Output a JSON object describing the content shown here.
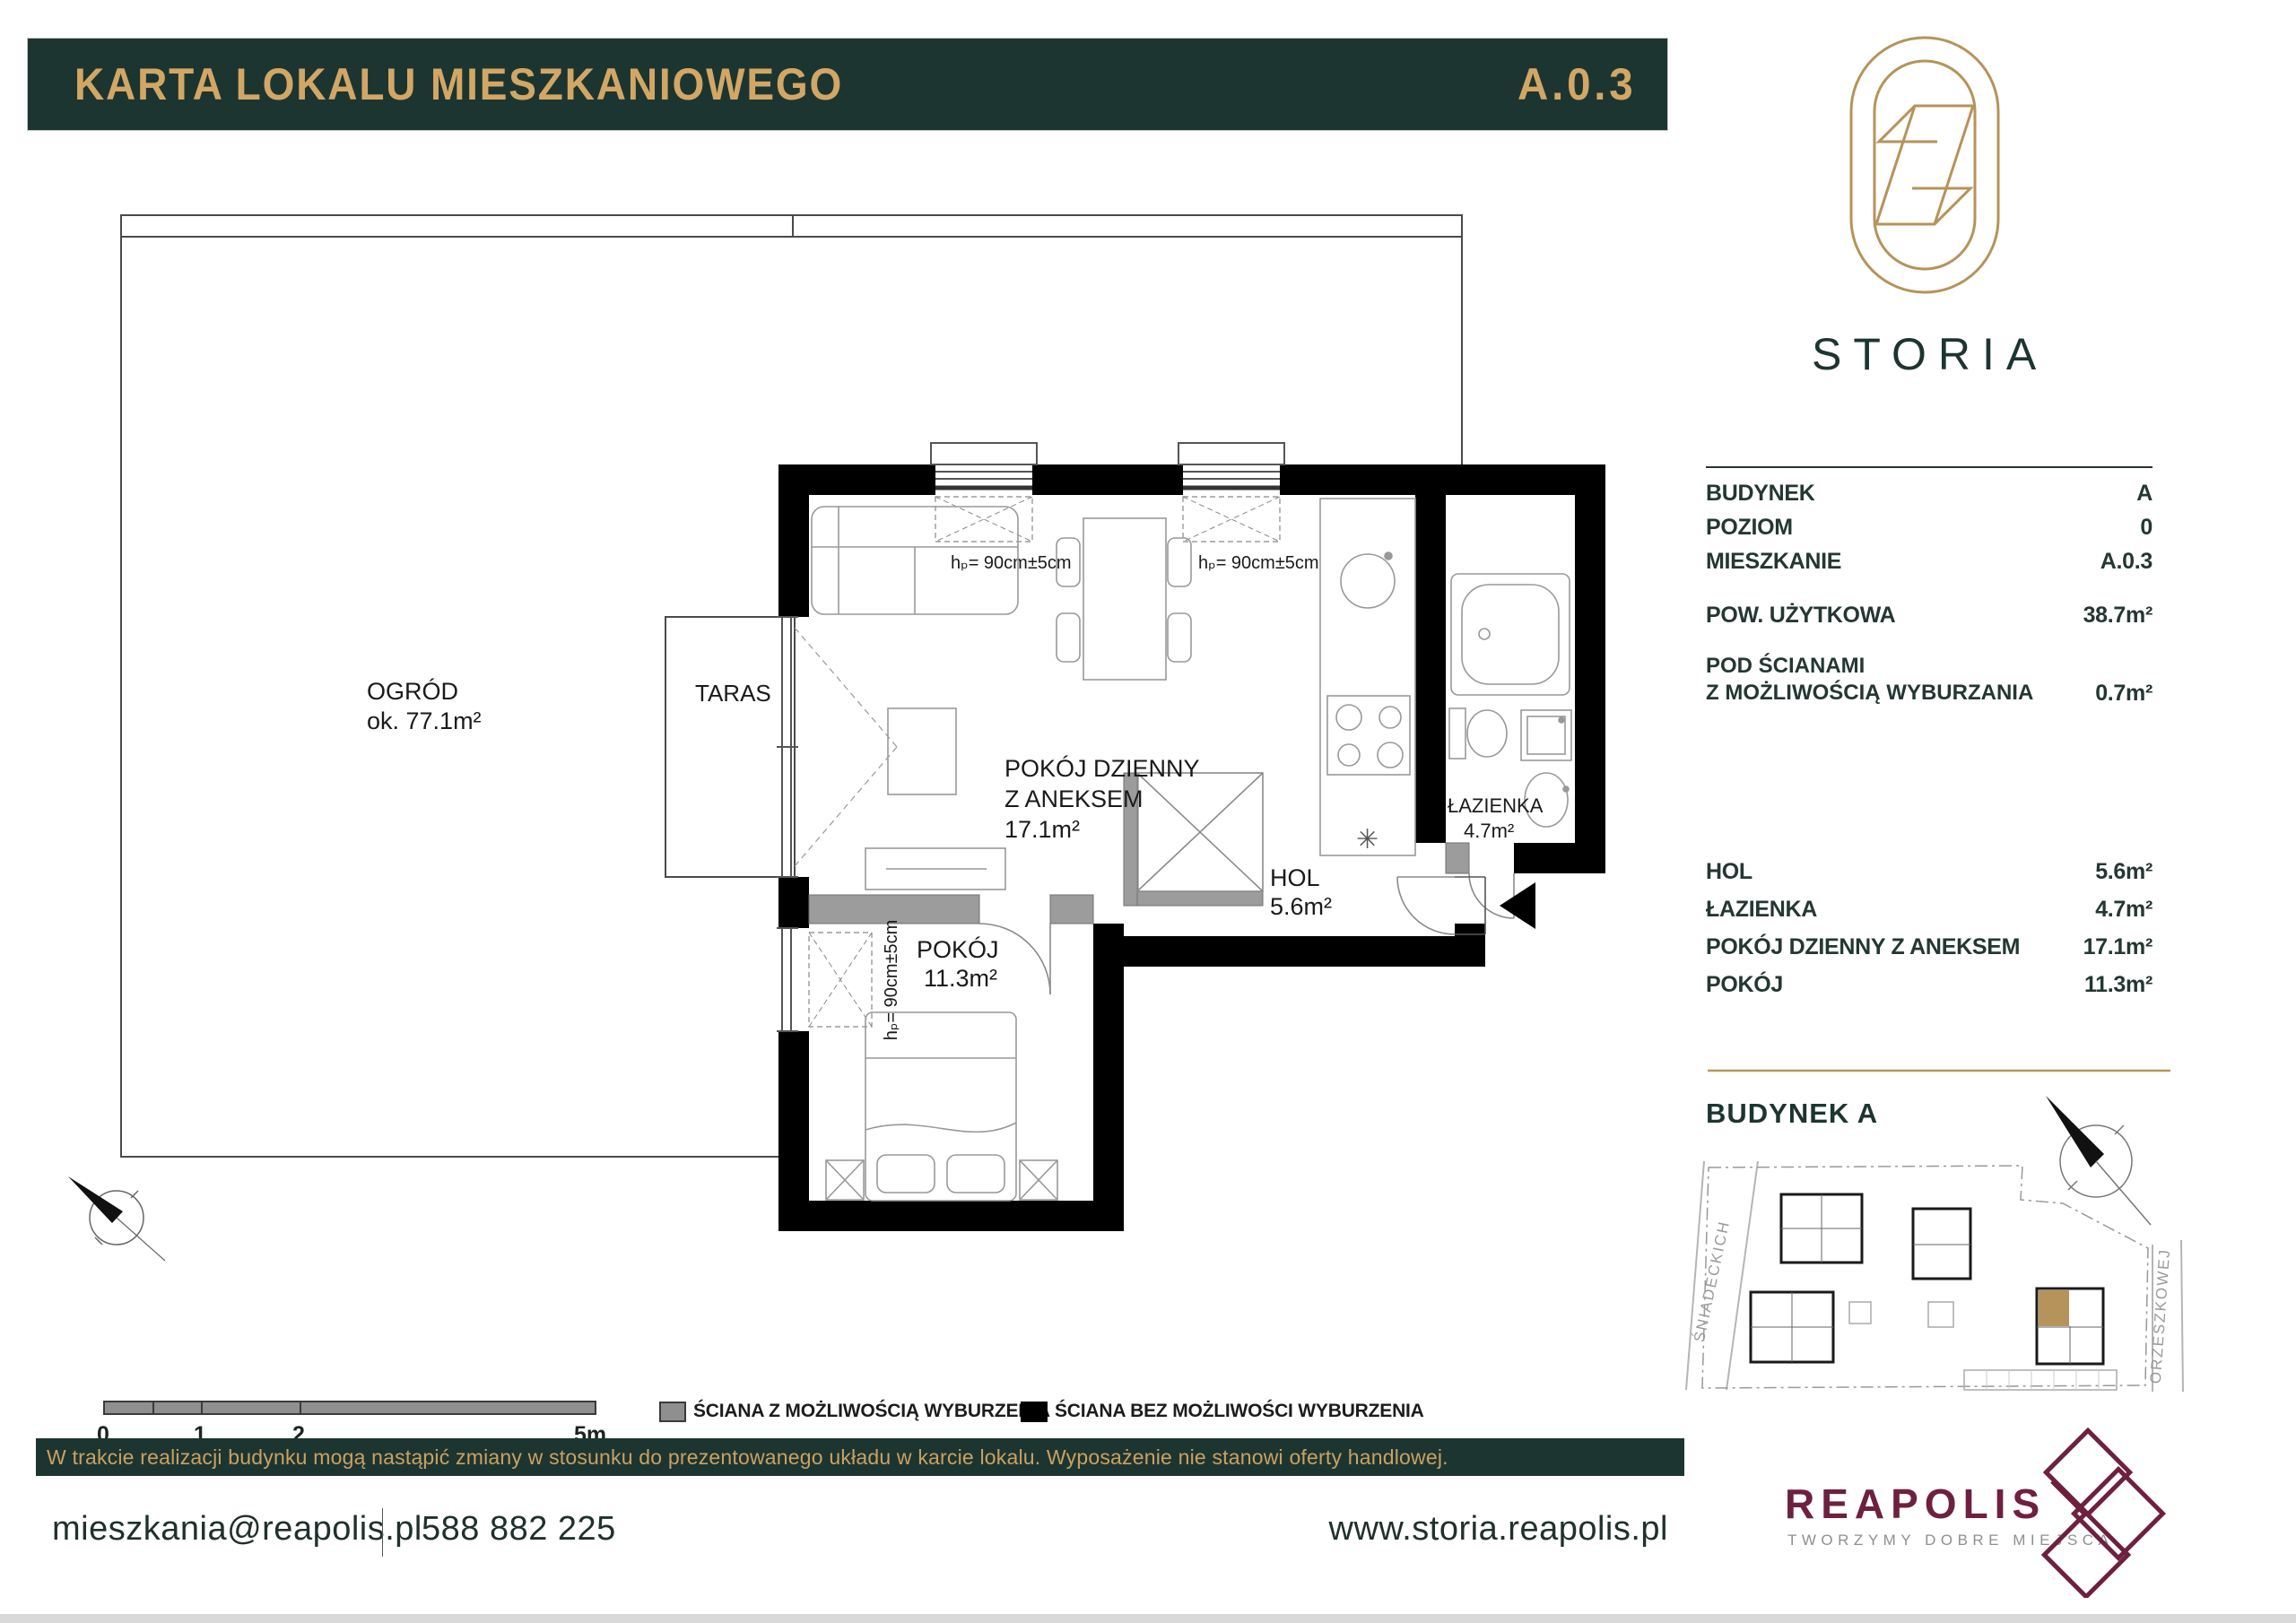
{
  "header": {
    "title": "KARTA LOKALU MIESZKANIOWEGO",
    "unit_code": "A.0.3"
  },
  "brand": {
    "name": "STORIA"
  },
  "info_panel": {
    "rows": [
      {
        "label": "BUDYNEK",
        "value": "A"
      },
      {
        "label": "POZIOM",
        "value": "0"
      },
      {
        "label": "MIESZKANIE",
        "value": "A.0.3"
      }
    ],
    "usable_area": {
      "label": "POW. UŻYTKOWA",
      "value": "38.7m²"
    },
    "demolition": {
      "label_line1": "POD ŚCIANAMI",
      "label_line2": "Z MOŻLIWOŚCIĄ WYBURZANIA",
      "value": "0.7m²"
    },
    "rooms": [
      {
        "name": "HOL",
        "area": "5.6m²"
      },
      {
        "name": "ŁAZIENKA",
        "area": "4.7m²"
      },
      {
        "name": "POKÓJ DZIENNY Z ANEKSEM",
        "area": "17.1m²"
      },
      {
        "name": "POKÓJ",
        "area": "11.3m²"
      }
    ]
  },
  "site_map": {
    "heading": "BUDYNEK A",
    "street_left": "ŚNIADECKICH",
    "street_right": "ORZESZKOWEJ",
    "highlight_color": "#b6935a"
  },
  "plan": {
    "garden": {
      "name": "OGRÓD",
      "area": "ok. 77.1m²"
    },
    "terrace": {
      "name": "TARAS"
    },
    "living": {
      "line1": "POKÓJ DZIENNY",
      "line2": "Z ANEKSEM",
      "area": "17.1m²"
    },
    "bathroom": {
      "name": "ŁAZIENKA",
      "area": "4.7m²"
    },
    "hall": {
      "name": "HOL",
      "area": "5.6m²"
    },
    "bedroom": {
      "name": "POKÓJ",
      "area": "11.3m²"
    },
    "window_label": "hₚ= 90cm±5cm",
    "kitchen_symbol": "✳"
  },
  "scale_bar": {
    "ticks": [
      "0",
      "1",
      "2",
      "5m"
    ]
  },
  "legend": [
    {
      "label": "ŚCIANA Z MOŻLIWOŚCIĄ WYBURZENIA",
      "swatch_color": "#8f8f8f"
    },
    {
      "label": "ŚCIANA BEZ MOŻLIWOŚCI WYBURZENIA",
      "swatch_color": "#000000"
    }
  ],
  "disclaimer": "W trakcie realizacji budynku mogą nastąpić zmiany w stosunku do prezentowanego układu w karcie lokalu.  Wyposażenie nie stanowi oferty handlowej.",
  "footer": {
    "email": "mieszkania@reapolis.pl",
    "phone": "588 882 225",
    "website": "www.storia.reapolis.pl",
    "partner": {
      "name": "REAPOLIS",
      "tagline": "TWORZYMY DOBRE MIEJSCA"
    }
  },
  "colors": {
    "dark_green": "#1d3531",
    "gold_text": "#d2a765",
    "gold_line": "#bb9659",
    "maroon": "#6e2040",
    "wall_black": "#000000",
    "wall_gray": "#9c9c9c"
  }
}
